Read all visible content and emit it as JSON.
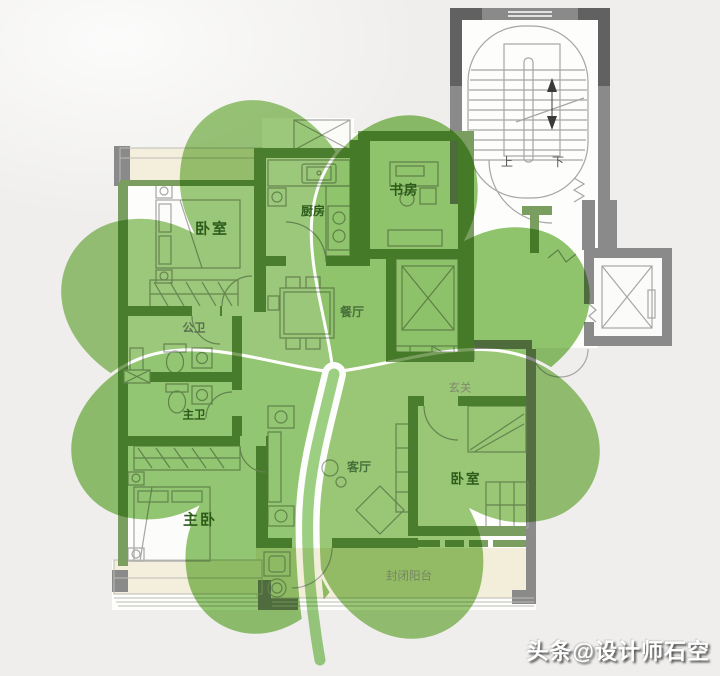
{
  "watermark": {
    "text": "头条@设计师石空"
  },
  "rooms": {
    "bedroom_top_left": {
      "label": "卧室"
    },
    "kitchen": {
      "label": "厨房"
    },
    "study": {
      "label": "书房"
    },
    "dining_room": {
      "label": "餐厅"
    },
    "guest_bathroom": {
      "label": "公卫"
    },
    "master_bathroom": {
      "label": "主卫"
    },
    "master_bedroom": {
      "label": "主卧"
    },
    "living_room": {
      "label": "客厅"
    },
    "entry_hall": {
      "label": "玄关"
    },
    "bedroom_right": {
      "label": "卧室"
    },
    "enclosed_balcony": {
      "label": "封闭阳台"
    }
  },
  "stairwell": {
    "up_label": "上",
    "down_label": "下"
  },
  "colors": {
    "background": "#efeeec",
    "clover_green": "#96c873",
    "stem_green": "#9ed184",
    "unit_wall_green": "#7a9e60",
    "exterior_wall_gray": "#8a8a8a",
    "bay_window_cream": "#f4eedd",
    "label_green": "#2c5b1a"
  }
}
